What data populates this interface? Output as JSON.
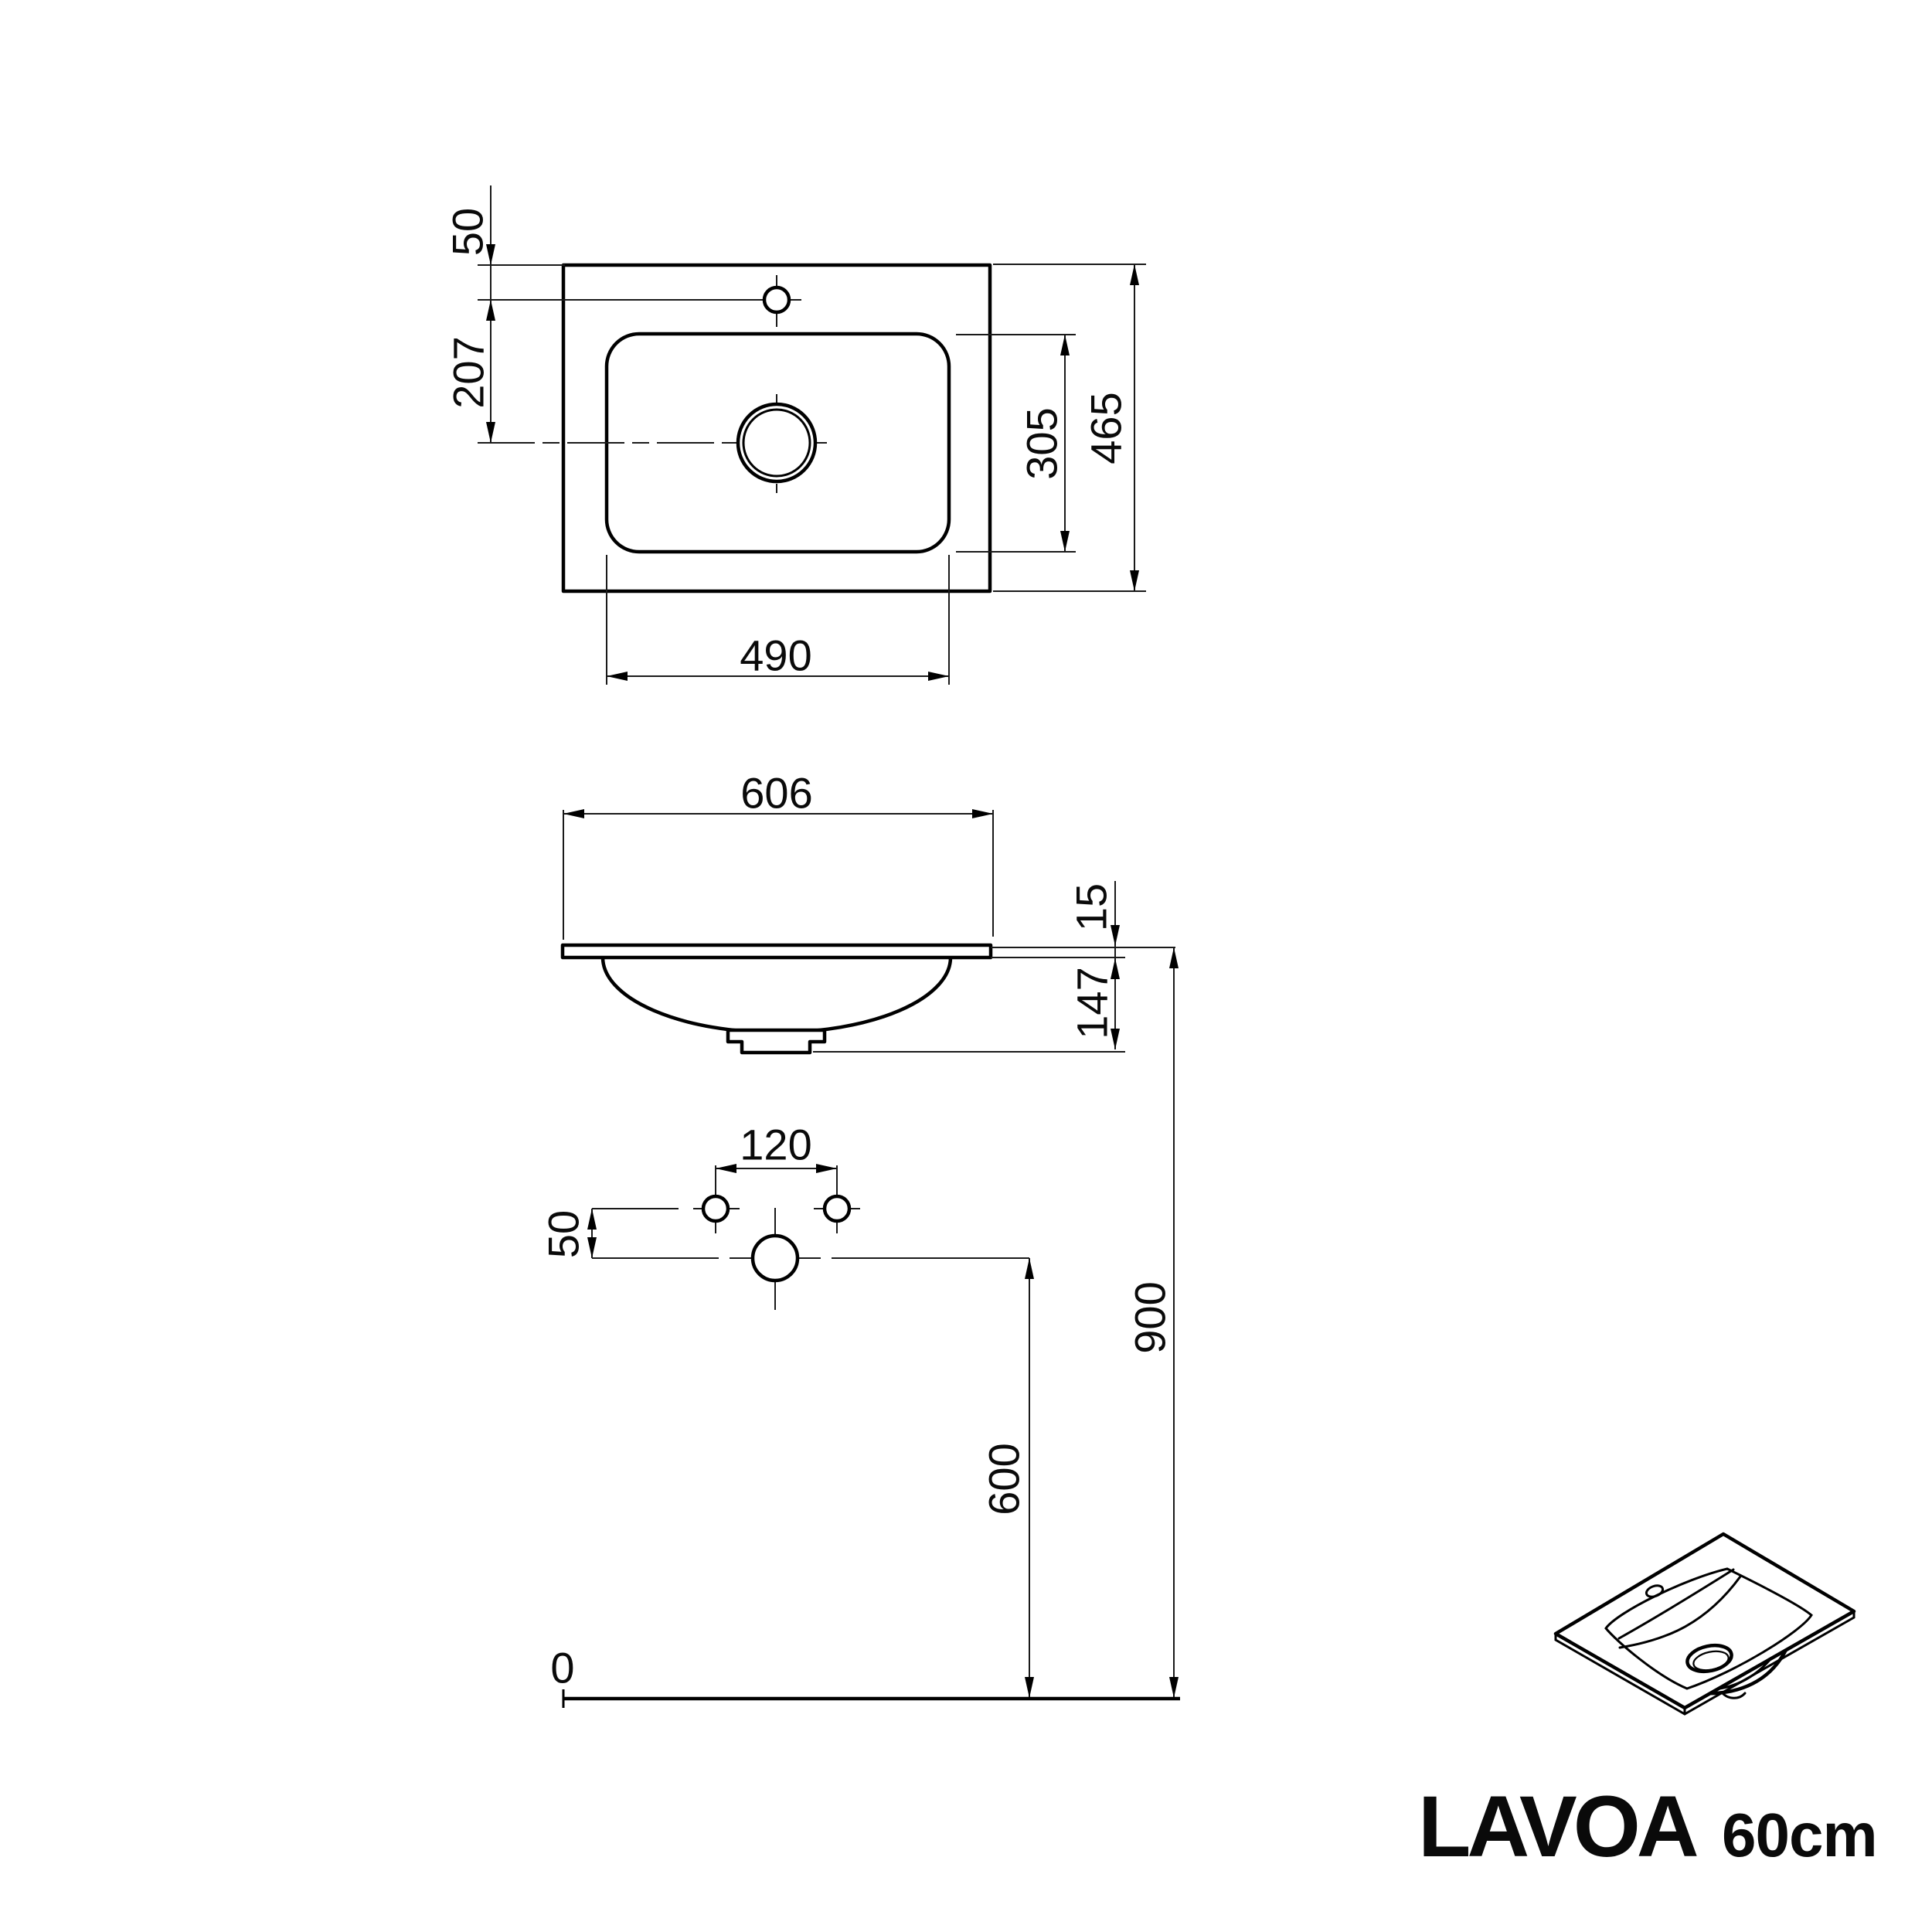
{
  "product": {
    "name": "LAVOA",
    "variant": "60cm"
  },
  "units": "mm",
  "dims": {
    "top": {
      "faucet_from_back_edge": "50",
      "drain_from_faucet": "207",
      "basin_width": "490",
      "basin_depth": "305",
      "overall_depth": "465"
    },
    "front": {
      "overall_width": "606",
      "rim_thickness": "15",
      "bowl_depth": "147"
    },
    "install": {
      "fixing_hole_spacing": "120",
      "drain_below_fixing_holes": "50",
      "drain_height_above_floor": "600",
      "rim_height_above_floor": "900",
      "floor_level": "0"
    }
  }
}
